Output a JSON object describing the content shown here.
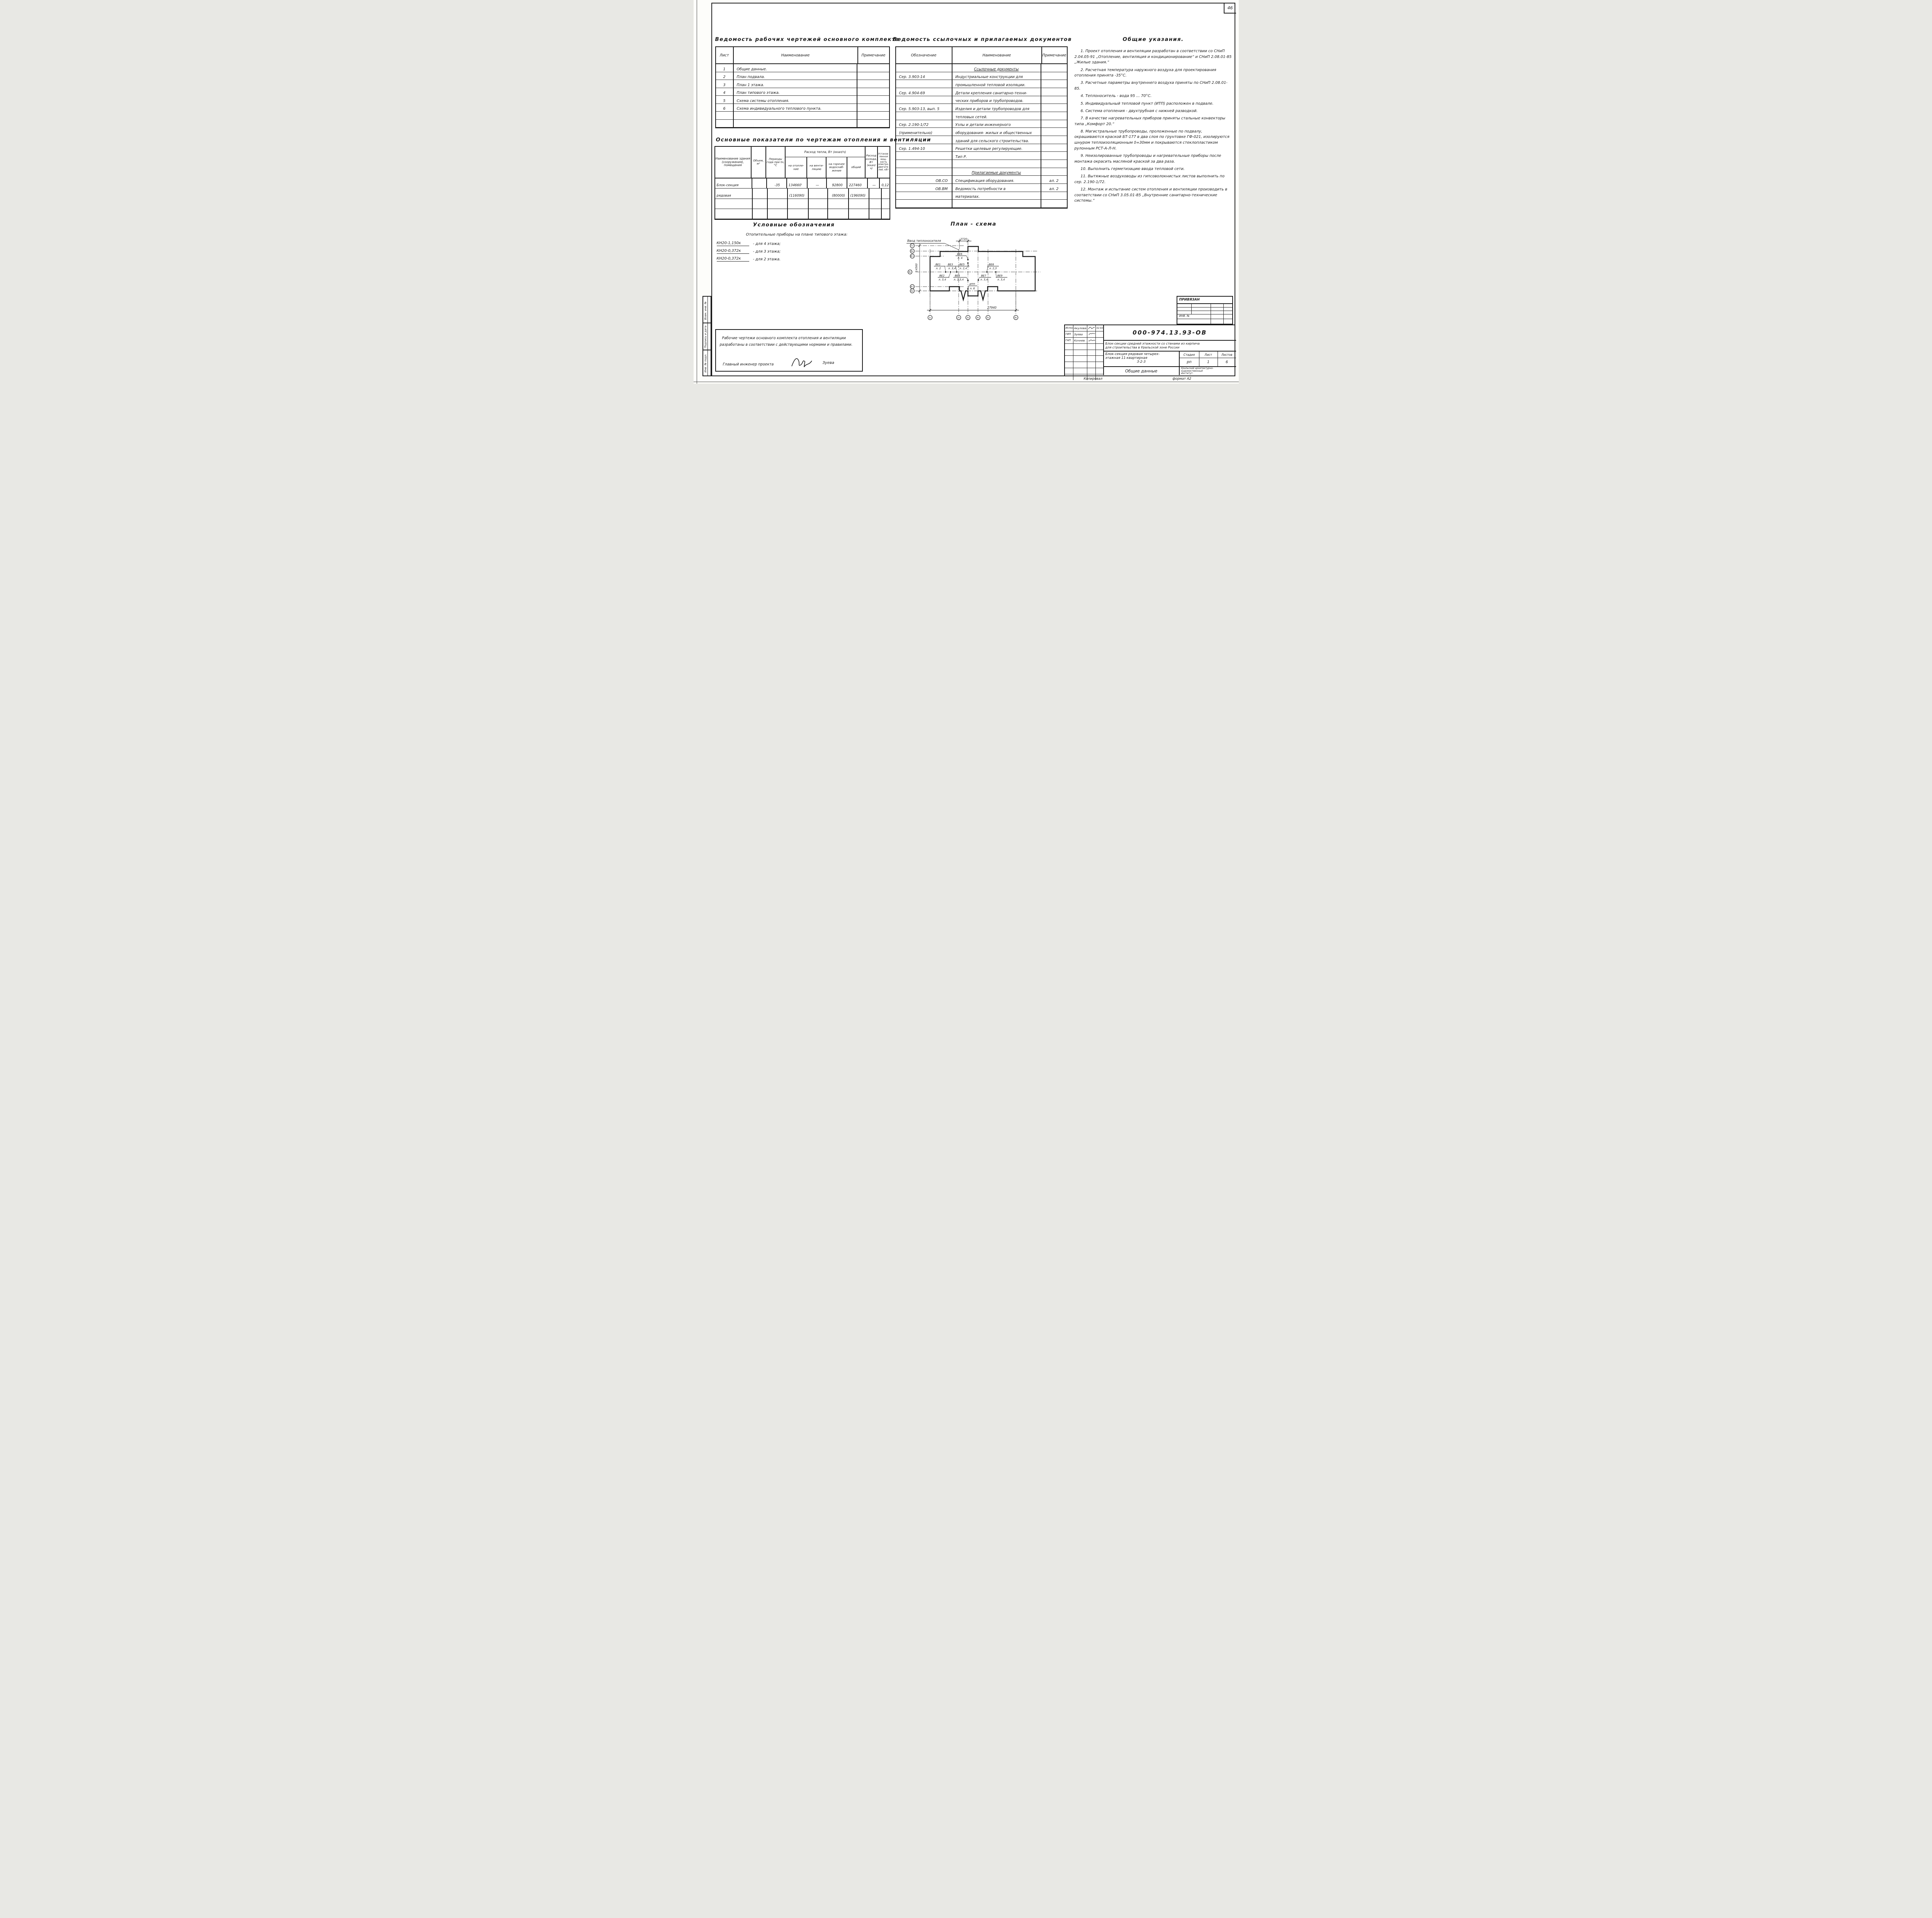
{
  "sheet": {
    "page_number": "46",
    "copied_label": "Копировал",
    "format_label": "формат А2"
  },
  "register": {
    "title": "Ведомость рабочих чертежей основного комплекта",
    "headers": {
      "sheet": "Лист",
      "name": "Наименование",
      "note": "Примечание"
    },
    "rows": [
      {
        "num": "1",
        "name": "Общие данные.",
        "note": "",
        "cls": ""
      },
      {
        "num": "2",
        "name": "План подвала.",
        "note": "",
        "cls": ""
      },
      {
        "num": "3",
        "name": "План 1 этажа.",
        "note": "",
        "cls": ""
      },
      {
        "num": "4",
        "name": "План типового этажа.",
        "note": "",
        "cls": ""
      },
      {
        "num": "5",
        "name": "Схема системы отопления.",
        "note": "",
        "cls": ""
      },
      {
        "num": "6",
        "name": "Схема индивидуального теплового пункта.",
        "note": "",
        "cls": ""
      },
      {
        "num": "",
        "name": "",
        "note": "",
        "cls": ""
      },
      {
        "num": "",
        "name": "",
        "note": "",
        "cls": ""
      }
    ]
  },
  "refdocs": {
    "title": "Ведомость ссылочных и прилагаемых документов",
    "headers": {
      "code": "Обозначение",
      "name": "Наименование",
      "note": "Примечание"
    },
    "rows": [
      {
        "code": "",
        "name": "Ссылочные документы",
        "note": "",
        "cls": "section"
      },
      {
        "code": "Сер. 3.903-14",
        "name": "Индустриальные конструкции для",
        "note": "",
        "cls": ""
      },
      {
        "code": "",
        "name": "промышленной тепловой изоляции.",
        "note": "",
        "cls": ""
      },
      {
        "code": "Сер. 4.904-69",
        "name": "Детали крепления санитарно-техни-",
        "note": "",
        "cls": ""
      },
      {
        "code": "",
        "name": "ческих приборов и трубопроводов.",
        "note": "",
        "cls": ""
      },
      {
        "code": "Сер. 5.903-13, вып. 5",
        "name": "Изделия и детали трубопроводов для",
        "note": "",
        "cls": ""
      },
      {
        "code": "",
        "name": "тепловых сетей.",
        "note": "",
        "cls": ""
      },
      {
        "code": "Сер. 2.190-1/72",
        "name": "Узлы и детали инженерного",
        "note": "",
        "cls": ""
      },
      {
        "code": "(применительно)",
        "name": "оборудования- жилых и общественных",
        "note": "",
        "cls": ""
      },
      {
        "code": "",
        "name": "зданий для сельского строительства.",
        "note": "",
        "cls": ""
      },
      {
        "code": "Сер. 1.494-10",
        "name": "Решетки щелевые регулирующие.",
        "note": "",
        "cls": ""
      },
      {
        "code": "",
        "name": "Тип Р.",
        "note": "",
        "cls": ""
      },
      {
        "code": "",
        "name": "",
        "note": "",
        "cls": ""
      },
      {
        "code": "",
        "name": "Прилагаемые документы",
        "note": "",
        "cls": "section"
      },
      {
        "code": "ОВ.СО",
        "name": "Спецификация оборудования.",
        "note": "ал. 2",
        "cls": "right-code"
      },
      {
        "code": "ОВ.ВМ",
        "name": "Ведомость потребности в",
        "note": "ал. 2",
        "cls": "right-code"
      },
      {
        "code": "",
        "name": "материалах.",
        "note": "",
        "cls": ""
      },
      {
        "code": "",
        "name": "",
        "note": "",
        "cls": ""
      }
    ]
  },
  "notes": {
    "title": "Общие указания.",
    "items": [
      "1. Проект отопления и вентиляции разработан в соответствии со СНиП 2.04.05-91 „Отопление, вентиляция и кондиционирование“ и СНиП 2.08.01-85 „Жилые здания.“",
      "2. Расчетная температура наружного воздуха для проектирования отопления принята -35°С.",
      "3. Расчетные параметры внутреннего воздуха приняты по СНиП 2.08.01-85.",
      "4. Теплоноситель - вода 95 ... 70°С.",
      "5. Индивидуальный тепловой пункт (ИТП) расположен в подвале.",
      "6. Система отопления - двухтрубная с нижней разводкой.",
      "7. В качестве нагревательных приборов приняты стальные конвекторы типа „Комфорт 20.“",
      "8. Магистральные трубопроводы, проложенные по подвалу, окрашиваются краской БТ-177 в два слоя по грунтовке ГФ-021, изолируются шнуром теплоизоляционным δ=30мм и покрываются стеклопластиком рулонным РСТ-А-Л-Н.",
      "9. Неизолированные трубопроводы и нагревательные приборы после монтажа окрасить масляной краской за два раза.",
      "10. Выполнить герметизацию ввода тепловой сети.",
      "11. Вытяжные воздуховоды из гипсоволокнистых листов выполнить по сер. 2.190-1/72.",
      "12. Монтаж и испытание систем отопления и вентиляции производить в соответствии со СНиП 3.05.01-85 „Внутренние санитарно-технические системы.“"
    ]
  },
  "indicators": {
    "title": "Основные показатели по чертежам отопления и вентиляции",
    "span_header": "Расход тепла, Вт (ккал/ч)",
    "headers": {
      "c0": "Наименование здания (сооружения), помещения",
      "c1": "Объем, м³",
      "c2": "Периоды года при tн, °С",
      "c3": "на отопле- ние",
      "c4": "на венти- ляцию",
      "c5": "на горячее водоснаб- жение",
      "c6": "общий",
      "c7": "Расход холода, Вт (ккал/ч)",
      "c8": "Установ- ленная мощ- ность электро- двигате- лей, кВт"
    },
    "rows": [
      {
        "c0": "Блок-секция",
        "c1": "",
        "c2": "-35",
        "c3": "134660'",
        "c4": "—",
        "c5": "92800",
        "c6": "227460",
        "c7": "—",
        "c8": "0,12"
      },
      {
        "c0": "рядовая",
        "c1": "",
        "c2": "",
        "c3": "(116090)",
        "c4": "",
        "c5": "(80000)",
        "c6": "(196090)",
        "c7": "",
        "c8": ""
      },
      {
        "c0": "",
        "c1": "",
        "c2": "",
        "c3": "",
        "c4": "",
        "c5": "",
        "c6": "",
        "c7": "",
        "c8": ""
      },
      {
        "c0": "",
        "c1": "",
        "c2": "",
        "c3": "",
        "c4": "",
        "c5": "",
        "c6": "",
        "c7": "",
        "c8": ""
      }
    ]
  },
  "legend": {
    "title": "Условные обозначения",
    "subtitle": "Отопительные приборы на плане типового этажа:",
    "items": [
      {
        "code": "КН20-1,150к",
        "desc": "-  для   4 этажа;"
      },
      {
        "code": "КН20-0,372к",
        "desc": "-  для   3 этажа;"
      },
      {
        "code": "КН20-0,372к",
        "desc": "-  для   2 этажа."
      }
    ]
  },
  "plan": {
    "title": "План - схема",
    "inlet": "Ввод теплоносителя",
    "dim_top": "2720",
    "dim_bottom": "27940",
    "dim_left": "14560",
    "axes_left": [
      "Гс",
      "Вс",
      "В'с",
      "Бс",
      "А'с",
      "Ас"
    ],
    "axes_bottom": [
      "1с",
      "2с",
      "3с",
      "4с",
      "5с",
      "6с"
    ],
    "units": [
      {
        "id": "ВЕ1",
        "fl": "л. 2"
      },
      {
        "id": "ВЕ2",
        "fl": "л. 3,4"
      },
      {
        "id": "ВЕ3",
        "fl": "л. 3,4"
      },
      {
        "id": "ВЕ4",
        "fl": "л. 2,3,4"
      },
      {
        "id": "ВЕ5",
        "fl": "л. 2,4"
      },
      {
        "id": "ВЕ6",
        "fl": "л. 4"
      },
      {
        "id": "ВЕ7",
        "fl": "л. 3,4"
      },
      {
        "id": "ВЕ8",
        "fl": "л. 2,3"
      },
      {
        "id": "ВЕ9",
        "fl": "л. 3,4"
      },
      {
        "id": "ИТП",
        "fl": "л. 6"
      }
    ]
  },
  "titleblock": {
    "doc_number": "000-974.13.93-ОВ",
    "desc1": "Блок-секции средней этажности со стенами из кирпича",
    "desc2": "для строительства в Уральской зоне России",
    "obj1": "Блок-секция рядовая четырех-",
    "obj2": "этажная 11-квартирная",
    "obj3": "3-2-3",
    "stage_label": "Стадия",
    "sheet_label": "Лист",
    "sheets_label": "Листов",
    "stage": "рп",
    "sheet": "1",
    "sheets": "6",
    "doc_title": "Общие данные",
    "org1": "Уральский архитектурно-",
    "org2": "художественный",
    "org3": "институт.",
    "attached": "ПРИВЯЗАН",
    "inv": "ИНВ. №",
    "people": [
      {
        "role": "Исполн.",
        "name": "Акулова",
        "date": "02.93"
      },
      {
        "role": "ГИП",
        "name": "Зуева",
        "date": ""
      },
      {
        "role": "ГАП",
        "name": "Кочнев",
        "date": ""
      }
    ]
  },
  "stamp_left": {
    "items": [
      "Взам. инв. №",
      "Подпись и дата",
      "Инв. № подл."
    ]
  },
  "notebox": {
    "line1": "Рабочие чертежи основного комплекта отопления и вентиляции",
    "line2": "разработаны в соответствии с действующими нормами и правилами.",
    "role": "Главный инженер проекта",
    "name": "Зуева"
  }
}
